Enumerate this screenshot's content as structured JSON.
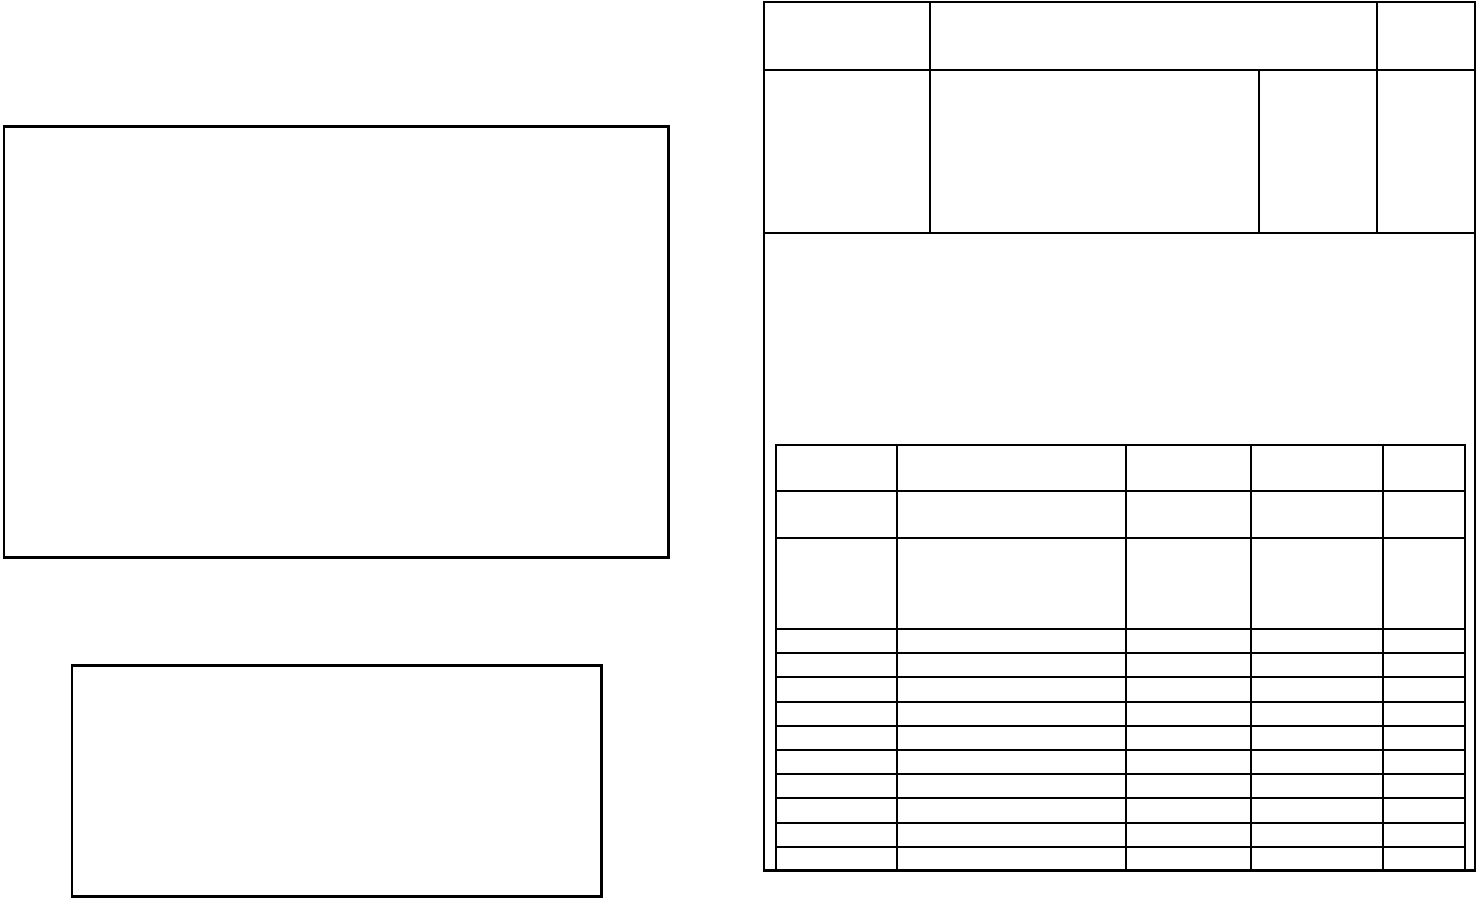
{
  "page": {
    "background_color": "#ffffff",
    "line_color": "#000000"
  },
  "left_column": {
    "main_box": {
      "content": ""
    },
    "note_box": {
      "content": ""
    }
  },
  "title_block_table": {
    "rows": [
      {
        "cells": [
          "",
          "",
          ""
        ]
      },
      {
        "cells": [
          "",
          "",
          "",
          ""
        ]
      }
    ]
  },
  "detail_table": {
    "rows": [
      {
        "cells": [
          "",
          "",
          "",
          "",
          ""
        ]
      },
      {
        "cells": [
          "",
          "",
          "",
          "",
          ""
        ]
      },
      {
        "cells": [
          "",
          "",
          "",
          "",
          ""
        ]
      },
      {
        "cells": [
          "",
          "",
          "",
          "",
          ""
        ]
      },
      {
        "cells": [
          "",
          "",
          "",
          "",
          ""
        ]
      },
      {
        "cells": [
          "",
          "",
          "",
          "",
          ""
        ]
      },
      {
        "cells": [
          "",
          "",
          "",
          "",
          ""
        ]
      },
      {
        "cells": [
          "",
          "",
          "",
          "",
          ""
        ]
      },
      {
        "cells": [
          "",
          "",
          "",
          "",
          ""
        ]
      },
      {
        "cells": [
          "",
          "",
          "",
          "",
          ""
        ]
      },
      {
        "cells": [
          "",
          "",
          "",
          "",
          ""
        ]
      },
      {
        "cells": [
          "",
          "",
          "",
          "",
          ""
        ]
      },
      {
        "cells": [
          "",
          "",
          "",
          "",
          ""
        ]
      }
    ]
  }
}
